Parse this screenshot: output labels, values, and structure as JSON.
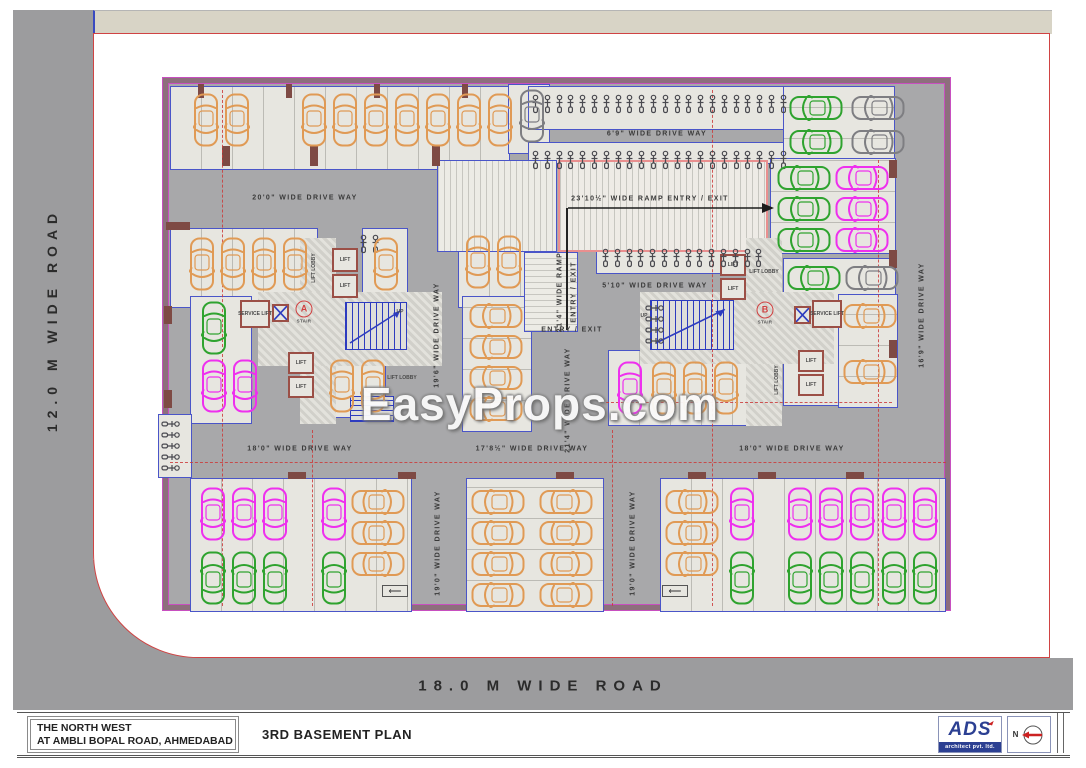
{
  "roads": {
    "left": "12.0 M WIDE ROAD",
    "bottom": "18.0 M WIDE ROAD"
  },
  "watermark": "EasyProps.com",
  "title_block": {
    "project_line1": "THE NORTH WEST",
    "project_line2": "AT AMBLI BOPAL ROAD, AHMEDABAD",
    "plan_title": "3RD BASEMENT PLAN",
    "firm_name": "ADS",
    "firm_tagline": "architect pvt. ltd.",
    "north_label": "N"
  },
  "palette": {
    "road_gray": "#9c9c9e",
    "strip_beige": "#d8d4c6",
    "plot_boundary_red": "#d04343",
    "plan_border_mauve": "#8d6f7c",
    "plan_border_magenta": "#c84fc0",
    "drive_gray": "#a8a8aa",
    "stall_light": "#e7e6e0",
    "wall_blue": "#4a55c8",
    "wall_brown": "#9b4f46",
    "grid_dash_red": "#cc3b3b",
    "car_orange": "#e09a55",
    "car_magenta": "#ee30ee",
    "car_green": "#2fa32f",
    "car_gray": "#7e7e82",
    "logo_blue": "#2b3f92",
    "north_arrow_red": "#cc2222"
  },
  "cores": {
    "a_letter": "A",
    "b_letter": "B",
    "stair": "STAIR",
    "lift": "LIFT",
    "lobby": "LIFT LOBBY",
    "service": "SERVICE LIFT",
    "up": "UP"
  },
  "drive_labels": [
    {
      "t": "20'0\" WIDE DRIVE WAY",
      "x": 305,
      "y": 198
    },
    {
      "t": "6'9\" WIDE DRIVE WAY",
      "x": 657,
      "y": 134
    },
    {
      "t": "23'10½\" WIDE RAMP ENTRY / EXIT",
      "x": 650,
      "y": 199
    },
    {
      "t": "5'10\" WIDE DRIVE WAY",
      "x": 655,
      "y": 286
    },
    {
      "t": "ENTRY / EXIT",
      "x": 572,
      "y": 330
    },
    {
      "t": "21'4\" WIDE RAMP",
      "x": 560,
      "y": 292,
      "v": 1
    },
    {
      "t": "ENTRY / EXIT",
      "x": 574,
      "y": 292,
      "v": 1
    },
    {
      "t": "19'6\" WIDE DRIVE WAY",
      "x": 437,
      "y": 335,
      "v": 1
    },
    {
      "t": "21'4\" WIDE DRIVE WAY",
      "x": 568,
      "y": 400,
      "v": 1
    },
    {
      "t": "16'9\" WIDE DRIVE WAY",
      "x": 922,
      "y": 315,
      "v": 1
    },
    {
      "t": "18'0\" WIDE DRIVE WAY",
      "x": 300,
      "y": 449
    },
    {
      "t": "17'8½\" WIDE DRIVE WAY",
      "x": 532,
      "y": 449
    },
    {
      "t": "18'0\" WIDE DRIVE WAY",
      "x": 792,
      "y": 449
    },
    {
      "t": "19'0\" WIDE DRIVE WAY",
      "x": 438,
      "y": 543,
      "v": 1
    },
    {
      "t": "19'0\" WIDE DRIVE WAY",
      "x": 633,
      "y": 543,
      "v": 1
    },
    {
      "t": "LIFT",
      "x": 345,
      "y": 260,
      "xs": 1
    },
    {
      "t": "LIFT",
      "x": 345,
      "y": 286,
      "xs": 1
    },
    {
      "t": "LIFT",
      "x": 301,
      "y": 363,
      "xs": 1
    },
    {
      "t": "LIFT",
      "x": 301,
      "y": 387,
      "xs": 1
    },
    {
      "t": "LIFT",
      "x": 733,
      "y": 265,
      "xs": 1
    },
    {
      "t": "LIFT",
      "x": 733,
      "y": 289,
      "xs": 1
    },
    {
      "t": "LIFT",
      "x": 811,
      "y": 361,
      "xs": 1
    },
    {
      "t": "LIFT",
      "x": 811,
      "y": 385,
      "xs": 1
    },
    {
      "t": "LIFT LOBBY",
      "x": 314,
      "y": 268,
      "v": 1,
      "xs": 1
    },
    {
      "t": "LIFT LOBBY",
      "x": 402,
      "y": 378,
      "xs": 1
    },
    {
      "t": "LIFT LOBBY",
      "x": 764,
      "y": 272,
      "xs": 1
    },
    {
      "t": "LIFT LOBBY",
      "x": 777,
      "y": 380,
      "v": 1,
      "xs": 1
    },
    {
      "t": "SERVICE LIFT",
      "x": 255,
      "y": 314,
      "xs": 1
    },
    {
      "t": "SERVICE LIFT",
      "x": 827,
      "y": 314,
      "xs": 1
    },
    {
      "t": "UP",
      "x": 400,
      "y": 312,
      "xs": 1
    },
    {
      "t": "UP",
      "x": 644,
      "y": 316,
      "xs": 1
    }
  ],
  "stair_markers": [
    {
      "letter": "A",
      "sub": "STAIR",
      "x": 304,
      "y": 312
    },
    {
      "letter": "B",
      "sub": "STAIR",
      "x": 765,
      "y": 313
    }
  ],
  "ramp_arrow": {
    "x1": 566,
    "x2": 762,
    "y": 208,
    "drop": 122
  },
  "zones": [
    {
      "t": "stall",
      "x": 170,
      "y": 86,
      "w": 340,
      "h": 84,
      "sep": "v"
    },
    {
      "t": "stall",
      "x": 508,
      "y": 84,
      "w": 42,
      "h": 70
    },
    {
      "t": "stall",
      "x": 528,
      "y": 86,
      "w": 262,
      "h": 44
    },
    {
      "t": "stall",
      "x": 528,
      "y": 142,
      "w": 262,
      "h": 22
    },
    {
      "t": "stall",
      "x": 783,
      "y": 86,
      "w": 112,
      "h": 84,
      "sep": "h"
    },
    {
      "t": "stall",
      "x": 770,
      "y": 158,
      "w": 126,
      "h": 96,
      "sep": "h"
    },
    {
      "t": "stall",
      "x": 783,
      "y": 258,
      "w": 113,
      "h": 148
    },
    {
      "t": "stall",
      "x": 170,
      "y": 228,
      "w": 148,
      "h": 80,
      "sep": "v"
    },
    {
      "t": "stall",
      "x": 190,
      "y": 296,
      "w": 62,
      "h": 128
    },
    {
      "t": "stall",
      "x": 322,
      "y": 352,
      "w": 64,
      "h": 66,
      "sep": "v"
    },
    {
      "t": "stall",
      "x": 362,
      "y": 228,
      "w": 46,
      "h": 80
    },
    {
      "t": "stall",
      "x": 458,
      "y": 228,
      "w": 80,
      "h": 80,
      "sep": "v"
    },
    {
      "t": "stall",
      "x": 462,
      "y": 296,
      "w": 70,
      "h": 136,
      "sep": "h"
    },
    {
      "t": "stall",
      "x": 608,
      "y": 350,
      "w": 154,
      "h": 76,
      "sep": "v"
    },
    {
      "t": "stall",
      "x": 838,
      "y": 294,
      "w": 60,
      "h": 114,
      "sep": "h"
    },
    {
      "t": "stall",
      "x": 190,
      "y": 478,
      "w": 222,
      "h": 134,
      "sep": "v"
    },
    {
      "t": "stall",
      "x": 466,
      "y": 478,
      "w": 138,
      "h": 134,
      "sep": "h"
    },
    {
      "t": "stall",
      "x": 660,
      "y": 478,
      "w": 286,
      "h": 134,
      "sep": "v"
    },
    {
      "t": "stall",
      "x": 596,
      "y": 244,
      "w": 172,
      "h": 30
    },
    {
      "t": "stall",
      "x": 158,
      "y": 414,
      "w": 34,
      "h": 64
    },
    {
      "t": "stall",
      "x": 640,
      "y": 298,
      "w": 34,
      "h": 56
    },
    {
      "t": "rampv",
      "x": 437,
      "y": 160,
      "w": 120,
      "h": 92
    },
    {
      "t": "rampm",
      "x": 558,
      "y": 160,
      "w": 210,
      "h": 92
    },
    {
      "t": "ramph",
      "x": 524,
      "y": 252,
      "w": 54,
      "h": 80
    },
    {
      "t": "lobby",
      "x": 300,
      "y": 238,
      "w": 36,
      "h": 186
    },
    {
      "t": "lobby",
      "x": 258,
      "y": 292,
      "w": 184,
      "h": 74
    },
    {
      "t": "lobby",
      "x": 746,
      "y": 238,
      "w": 36,
      "h": 188
    },
    {
      "t": "lobby",
      "x": 640,
      "y": 292,
      "w": 194,
      "h": 72
    },
    {
      "t": "room",
      "x": 332,
      "y": 248,
      "w": 26,
      "h": 24
    },
    {
      "t": "room",
      "x": 332,
      "y": 274,
      "w": 26,
      "h": 24
    },
    {
      "t": "room",
      "x": 288,
      "y": 352,
      "w": 26,
      "h": 22
    },
    {
      "t": "room",
      "x": 288,
      "y": 376,
      "w": 26,
      "h": 22
    },
    {
      "t": "room",
      "x": 240,
      "y": 300,
      "w": 30,
      "h": 28
    },
    {
      "t": "room",
      "x": 720,
      "y": 254,
      "w": 26,
      "h": 22
    },
    {
      "t": "room",
      "x": 720,
      "y": 278,
      "w": 26,
      "h": 22
    },
    {
      "t": "room",
      "x": 798,
      "y": 350,
      "w": 26,
      "h": 22
    },
    {
      "t": "room",
      "x": 798,
      "y": 374,
      "w": 26,
      "h": 22
    },
    {
      "t": "room",
      "x": 812,
      "y": 300,
      "w": 30,
      "h": 28
    },
    {
      "t": "shaft",
      "x": 272,
      "y": 304,
      "w": 17,
      "h": 18
    },
    {
      "t": "shaft",
      "x": 794,
      "y": 306,
      "w": 17,
      "h": 18
    },
    {
      "t": "stair",
      "x": 345,
      "y": 302,
      "w": 62,
      "h": 48
    },
    {
      "t": "stairh",
      "x": 350,
      "y": 396,
      "w": 44,
      "h": 26
    },
    {
      "t": "stair",
      "x": 650,
      "y": 300,
      "w": 84,
      "h": 50
    },
    {
      "t": "wall",
      "x": 222,
      "y": 146,
      "w": 8,
      "h": 20
    },
    {
      "t": "wall",
      "x": 310,
      "y": 146,
      "w": 8,
      "h": 20
    },
    {
      "t": "wall",
      "x": 432,
      "y": 146,
      "w": 8,
      "h": 20
    },
    {
      "t": "wall",
      "x": 198,
      "y": 84,
      "w": 6,
      "h": 14
    },
    {
      "t": "wall",
      "x": 286,
      "y": 84,
      "w": 6,
      "h": 14
    },
    {
      "t": "wall",
      "x": 374,
      "y": 84,
      "w": 6,
      "h": 14
    },
    {
      "t": "wall",
      "x": 462,
      "y": 84,
      "w": 6,
      "h": 14
    },
    {
      "t": "wall",
      "x": 288,
      "y": 472,
      "w": 18,
      "h": 7
    },
    {
      "t": "wall",
      "x": 398,
      "y": 472,
      "w": 18,
      "h": 7
    },
    {
      "t": "wall",
      "x": 556,
      "y": 472,
      "w": 18,
      "h": 7
    },
    {
      "t": "wall",
      "x": 688,
      "y": 472,
      "w": 18,
      "h": 7
    },
    {
      "t": "wall",
      "x": 758,
      "y": 472,
      "w": 18,
      "h": 7
    },
    {
      "t": "wall",
      "x": 846,
      "y": 472,
      "w": 18,
      "h": 7
    },
    {
      "t": "wall",
      "x": 166,
      "y": 222,
      "w": 24,
      "h": 8
    },
    {
      "t": "wall",
      "x": 164,
      "y": 306,
      "w": 8,
      "h": 18
    },
    {
      "t": "wall",
      "x": 164,
      "y": 390,
      "w": 8,
      "h": 18
    },
    {
      "t": "wall",
      "x": 889,
      "y": 160,
      "w": 8,
      "h": 18
    },
    {
      "t": "wall",
      "x": 889,
      "y": 250,
      "w": 8,
      "h": 18
    },
    {
      "t": "wall",
      "x": 889,
      "y": 340,
      "w": 8,
      "h": 18
    },
    {
      "t": "arrowbox",
      "x": 382,
      "y": 585,
      "w": 26,
      "h": 12
    },
    {
      "t": "arrowbox",
      "x": 662,
      "y": 585,
      "w": 26,
      "h": 12
    }
  ],
  "dashes": {
    "v": [
      {
        "x": 222,
        "y1": 90,
        "y2": 606
      },
      {
        "x": 712,
        "y1": 90,
        "y2": 606
      },
      {
        "x": 878,
        "y1": 160,
        "y2": 606
      },
      {
        "x": 312,
        "y1": 430,
        "y2": 606
      },
      {
        "x": 612,
        "y1": 430,
        "y2": 606
      }
    ],
    "h": [
      {
        "y": 462,
        "x1": 170,
        "x2": 946
      },
      {
        "y": 402,
        "x1": 606,
        "x2": 892
      }
    ]
  },
  "cars": [
    {
      "x": 190,
      "y": 92,
      "n": 2,
      "c": "orange",
      "d": "v",
      "r": 180
    },
    {
      "x": 298,
      "y": 92,
      "n": 7,
      "c": "orange",
      "d": "v",
      "r": 180
    },
    {
      "x": 516,
      "y": 88,
      "n": 1,
      "c": "gray",
      "d": "v",
      "r": 180
    },
    {
      "x": 788,
      "y": 92,
      "n": 1,
      "c": "green",
      "d": "h",
      "r": -90
    },
    {
      "x": 850,
      "y": 92,
      "n": 1,
      "c": "gray",
      "d": "h",
      "r": -90
    },
    {
      "x": 788,
      "y": 126,
      "n": 1,
      "c": "green",
      "d": "h",
      "r": -90
    },
    {
      "x": 850,
      "y": 126,
      "n": 1,
      "c": "gray",
      "d": "h",
      "r": -90
    },
    {
      "x": 776,
      "y": 162,
      "n": 3,
      "c": "green",
      "d": "h",
      "r": -90
    },
    {
      "x": 834,
      "y": 162,
      "n": 3,
      "c": "magenta",
      "d": "h",
      "r": -90
    },
    {
      "x": 786,
      "y": 262,
      "n": 1,
      "c": "green",
      "d": "h",
      "r": -90
    },
    {
      "x": 844,
      "y": 262,
      "n": 1,
      "c": "gray",
      "d": "h",
      "r": -90
    },
    {
      "x": 842,
      "y": 300,
      "n": 1,
      "c": "orange",
      "d": "h",
      "r": -90
    },
    {
      "x": 842,
      "y": 356,
      "n": 1,
      "c": "orange",
      "d": "h",
      "r": -90
    },
    {
      "x": 186,
      "y": 236,
      "n": 4,
      "c": "orange",
      "d": "v",
      "r": 180
    },
    {
      "x": 370,
      "y": 236,
      "n": 1,
      "c": "orange",
      "d": "v",
      "r": 180
    },
    {
      "x": 462,
      "y": 234,
      "n": 2,
      "c": "orange",
      "d": "v",
      "r": 180
    },
    {
      "x": 198,
      "y": 300,
      "n": 1,
      "c": "green",
      "d": "v",
      "r": 180
    },
    {
      "x": 198,
      "y": 358,
      "n": 2,
      "c": "magenta",
      "d": "v",
      "r": 180
    },
    {
      "x": 326,
      "y": 358,
      "n": 2,
      "c": "orange",
      "d": "v",
      "r": 180
    },
    {
      "x": 468,
      "y": 300,
      "n": 4,
      "c": "orange",
      "d": "h",
      "r": -90
    },
    {
      "x": 614,
      "y": 360,
      "n": 1,
      "c": "magenta",
      "d": "v",
      "r": 180
    },
    {
      "x": 648,
      "y": 360,
      "n": 3,
      "c": "orange",
      "d": "v",
      "r": 180
    },
    {
      "x": 197,
      "y": 486,
      "n": 3,
      "c": "magenta",
      "d": "v",
      "r": 180
    },
    {
      "x": 318,
      "y": 486,
      "n": 1,
      "c": "magenta",
      "d": "v",
      "r": 180
    },
    {
      "x": 197,
      "y": 550,
      "n": 3,
      "c": "green",
      "d": "v",
      "r": 0
    },
    {
      "x": 318,
      "y": 550,
      "n": 1,
      "c": "green",
      "d": "v",
      "r": 0
    },
    {
      "x": 350,
      "y": 486,
      "n": 3,
      "c": "orange",
      "d": "h",
      "r": 90
    },
    {
      "x": 470,
      "y": 486,
      "n": 4,
      "c": "orange",
      "d": "h",
      "r": -90
    },
    {
      "x": 538,
      "y": 486,
      "n": 4,
      "c": "orange",
      "d": "h",
      "r": 90
    },
    {
      "x": 664,
      "y": 486,
      "n": 3,
      "c": "orange",
      "d": "h",
      "r": -90
    },
    {
      "x": 726,
      "y": 486,
      "n": 1,
      "c": "magenta",
      "d": "v",
      "r": 180
    },
    {
      "x": 784,
      "y": 486,
      "n": 3,
      "c": "magenta",
      "d": "v",
      "r": 180
    },
    {
      "x": 878,
      "y": 486,
      "n": 2,
      "c": "magenta",
      "d": "v",
      "r": 180
    },
    {
      "x": 726,
      "y": 550,
      "n": 1,
      "c": "green",
      "d": "v",
      "r": 0
    },
    {
      "x": 784,
      "y": 550,
      "n": 3,
      "c": "green",
      "d": "v",
      "r": 0
    },
    {
      "x": 878,
      "y": 550,
      "n": 2,
      "c": "green",
      "d": "v",
      "r": 0
    }
  ],
  "bikes": [
    {
      "x": 530,
      "y": 94,
      "n": 22,
      "d": "row"
    },
    {
      "x": 530,
      "y": 150,
      "n": 22,
      "d": "row"
    },
    {
      "x": 600,
      "y": 248,
      "n": 14,
      "d": "row"
    },
    {
      "x": 160,
      "y": 418,
      "n": 5,
      "d": "col"
    },
    {
      "x": 644,
      "y": 302,
      "n": 4,
      "d": "col"
    },
    {
      "x": 358,
      "y": 234,
      "n": 2,
      "d": "row"
    }
  ]
}
